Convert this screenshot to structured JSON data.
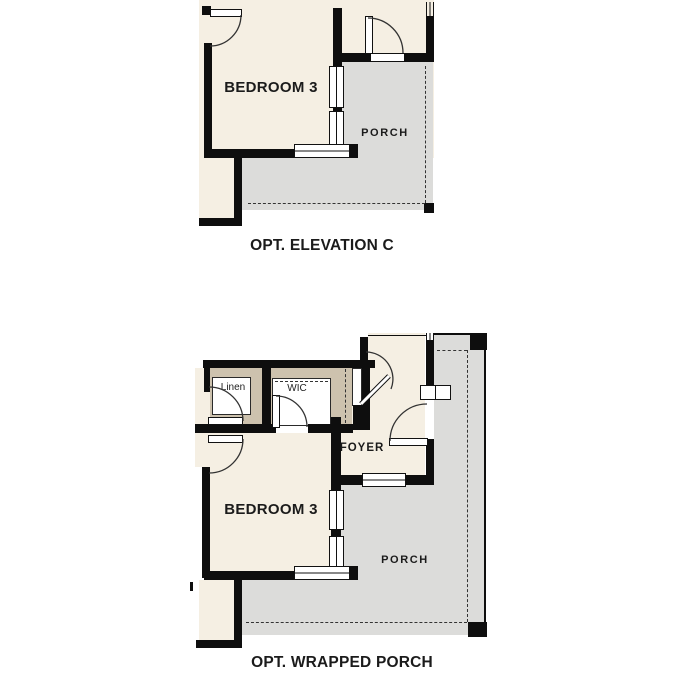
{
  "colors": {
    "cream": "#f5efe3",
    "porch_gray": "#dcdcda",
    "closet_tan": "#cdc2ae",
    "wall": "#0e0e0e",
    "text": "#1b1b1b"
  },
  "plan_top": {
    "caption": "OPT. ELEVATION C",
    "rooms": {
      "bedroom": "BEDROOM 3",
      "porch": "PORCH"
    }
  },
  "plan_bottom": {
    "caption": "OPT. WRAPPED PORCH",
    "rooms": {
      "bedroom": "BEDROOM 3",
      "porch": "PORCH",
      "foyer": "FOYER",
      "linen": "Linen",
      "wic": "WIC"
    }
  }
}
